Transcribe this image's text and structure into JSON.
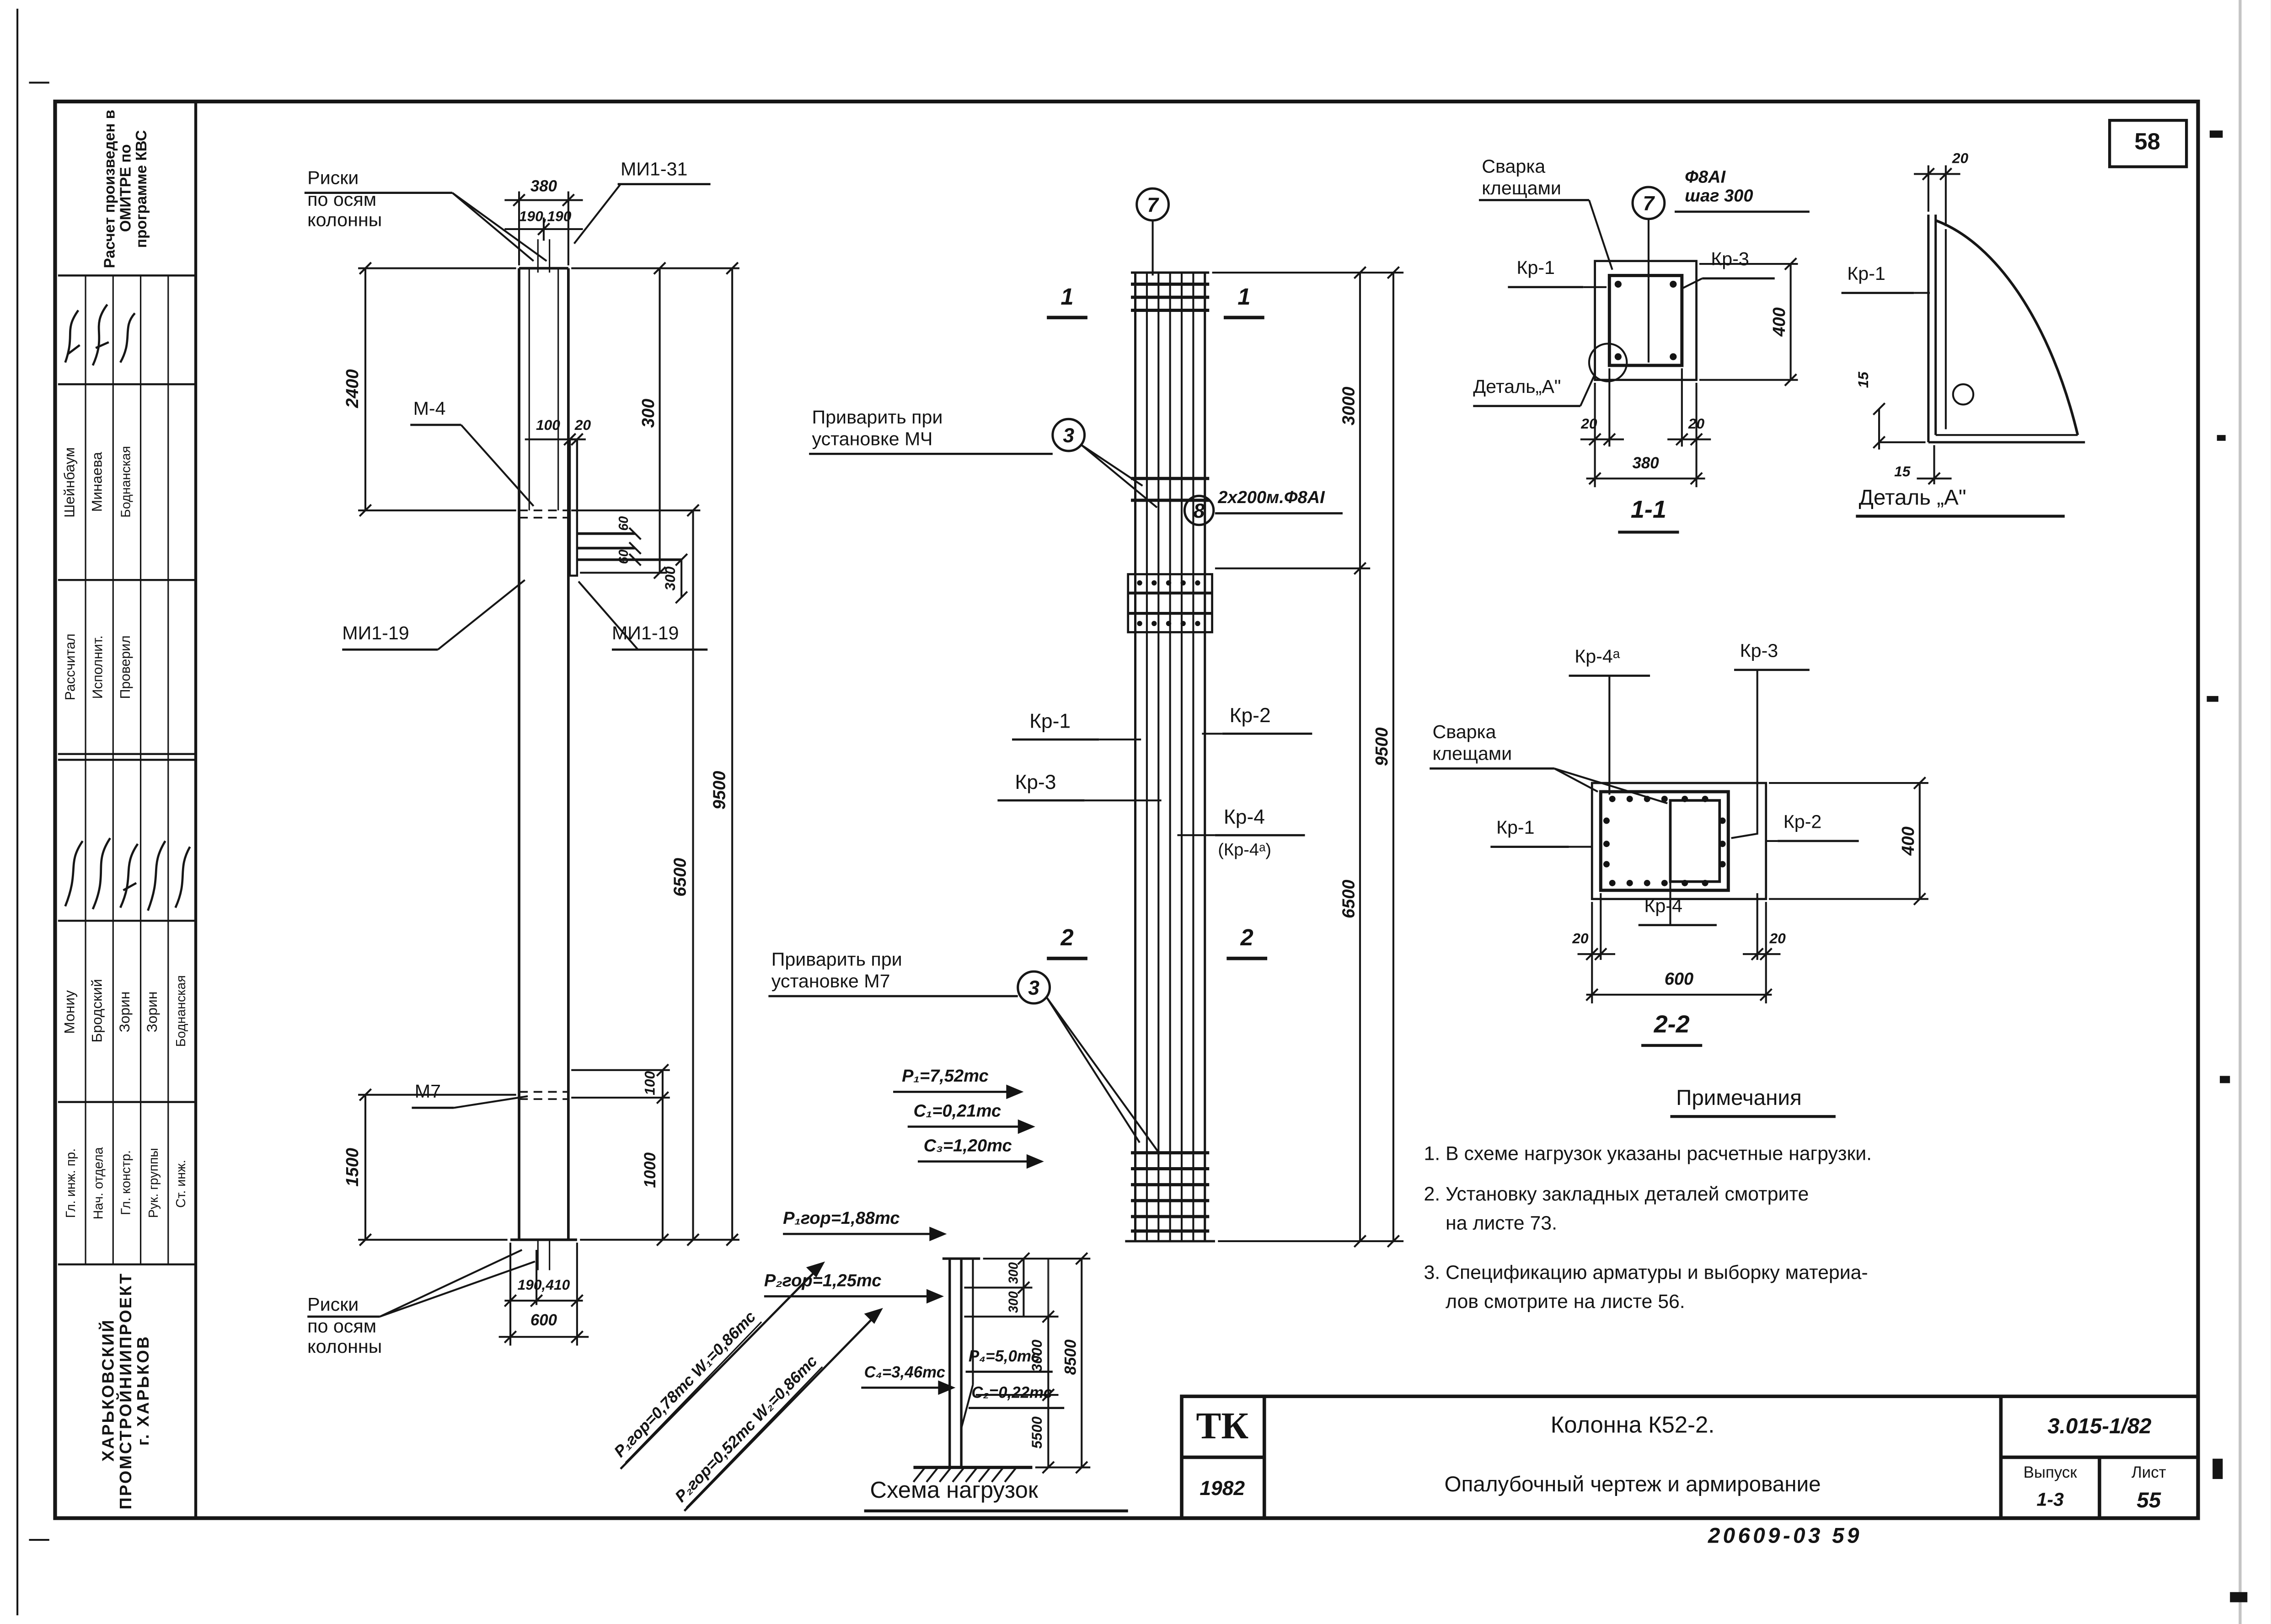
{
  "page": {
    "sheet_number_top_right": "58",
    "doc_code_bottom": "20609-03  59"
  },
  "stamp": {
    "calc_note": "Расчет произведен в ОМИТРЕ по программе КВС",
    "group1_roles": [
      "Рассчитал",
      "Исполнит.",
      "Проверил"
    ],
    "group1_names": [
      "Шейнбаум",
      "Минаева",
      "Боднанская"
    ],
    "group2_roles": [
      "Гл. инж. пр.",
      "Нач. отдела",
      "Гл. констр.",
      "Рук. группы",
      "Ст. инж."
    ],
    "group2_names": [
      "Мониу",
      "Бродский",
      "Зорин",
      "Зорин",
      "Боднанская"
    ],
    "organization": "ХАРЬКОВСКИЙ\nПРОМСТРОЙНИИПРОЕКТ\nг. ХАРЬКОВ"
  },
  "elevation": {
    "risk_top": "Риски\nпо осям\nколонны",
    "risk_bottom": "Риски\nпо осям\nколонны",
    "mi1_31": "МИ1-31",
    "mi1_19_left": "МИ1-19",
    "mi1_19_right": "МИ1-19",
    "m4": "М-4",
    "m7": "М7",
    "dim_380": "380",
    "dim_190_190": "190,190",
    "dim_2400": "2400",
    "dim_100": "100",
    "dim_20": "20",
    "dim_300_top": "300",
    "dim_9500": "9500",
    "dim_6500": "6500",
    "dim_60a": "60",
    "dim_60b": "60",
    "dim_300_console": "300",
    "dim_1500": "1500",
    "dim_100_bottom": "100",
    "dim_1000": "1000",
    "dim_190_410": "190,410",
    "dim_600": "600"
  },
  "reinforcement": {
    "callout_top": "7",
    "callout_weld_top": "3",
    "callout_bars": "8",
    "callout_weld_bottom": "3",
    "weld_top": "Приварить при\nустановке МЧ",
    "weld_bottom": "Приварить при\nустановке М7",
    "bars_note": "2х200м.Ф8АІ",
    "kr1": "Кр-1",
    "kr2": "Кр-2",
    "kr3": "Кр-3",
    "kr4": "Кр-4",
    "kr4a": "(Кр-4ᵃ)",
    "sec1_left": "1",
    "sec1_right": "1",
    "sec2_left": "2",
    "sec2_right": "2",
    "dim_3000": "3000",
    "dim_9500": "9500",
    "dim_6500": "6500"
  },
  "load_scheme": {
    "title": "Схема нагрузок",
    "p1": "Р₁=7,52тс",
    "c1": "С₁=0,21тс",
    "c3": "С₃=1,20тс",
    "p1gor": "Р₁гор=1,88тс",
    "p2gor": "Р₂гор=1,25тс",
    "diag1": "Р₁гор=0,78тс  W₁=0,86тс",
    "diag2": "Р₂гор=0,52тс  W₂=0,86тс",
    "c4": "С₄=3,46тс",
    "p4": "Р₄=5,0тс",
    "c2": "С₂=0,22тс",
    "dim_300a": "300",
    "dim_300b": "300",
    "dim_3000": "3000",
    "dim_5500": "5500",
    "dim_8500": "8500"
  },
  "section11": {
    "weld": "Сварка\nклещами",
    "callout": "7",
    "rebar": "Ф8АІ\nшаг 300",
    "kr1": "Кр-1",
    "kr3": "Кр-3",
    "detail_ref": "Деталь„А\"",
    "dim_400": "400",
    "dim_20l": "20",
    "dim_20r": "20",
    "dim_380": "380",
    "caption": "1-1"
  },
  "detail_a": {
    "dim_20": "20",
    "kr1": "Кр-1",
    "dim_15_left": "15",
    "dim_15_bottom": "15",
    "caption": "Деталь „А\""
  },
  "section22": {
    "kr4a": "Кр-4ᵃ",
    "kr3": "Кр-3",
    "weld": "Сварка\nклещами",
    "kr1": "Кр-1",
    "kr2": "Кр-2",
    "kr4": "Кр-4",
    "dim_400": "400",
    "dim_20l": "20",
    "dim_20r": "20",
    "dim_600": "600",
    "caption": "2-2"
  },
  "notes": {
    "title": "Примечания",
    "items": [
      "1. В схеме нагрузок указаны расчетные нагрузки.",
      "2. Установку закладных деталей смотрите\n    на листе 73.",
      "3. Спецификацию арматуры и выборку материа-\n    лов смотрите на листе 56."
    ]
  },
  "titleblock": {
    "logo": "ТК",
    "year": "1982",
    "title_line1": "Колонна К52-2.",
    "title_line2": "Опалубочный чертеж и армирование",
    "series": "3.015-1/82",
    "issue_label": "Выпуск",
    "issue": "1-3",
    "sheet_label": "Лист",
    "sheet": "55"
  }
}
